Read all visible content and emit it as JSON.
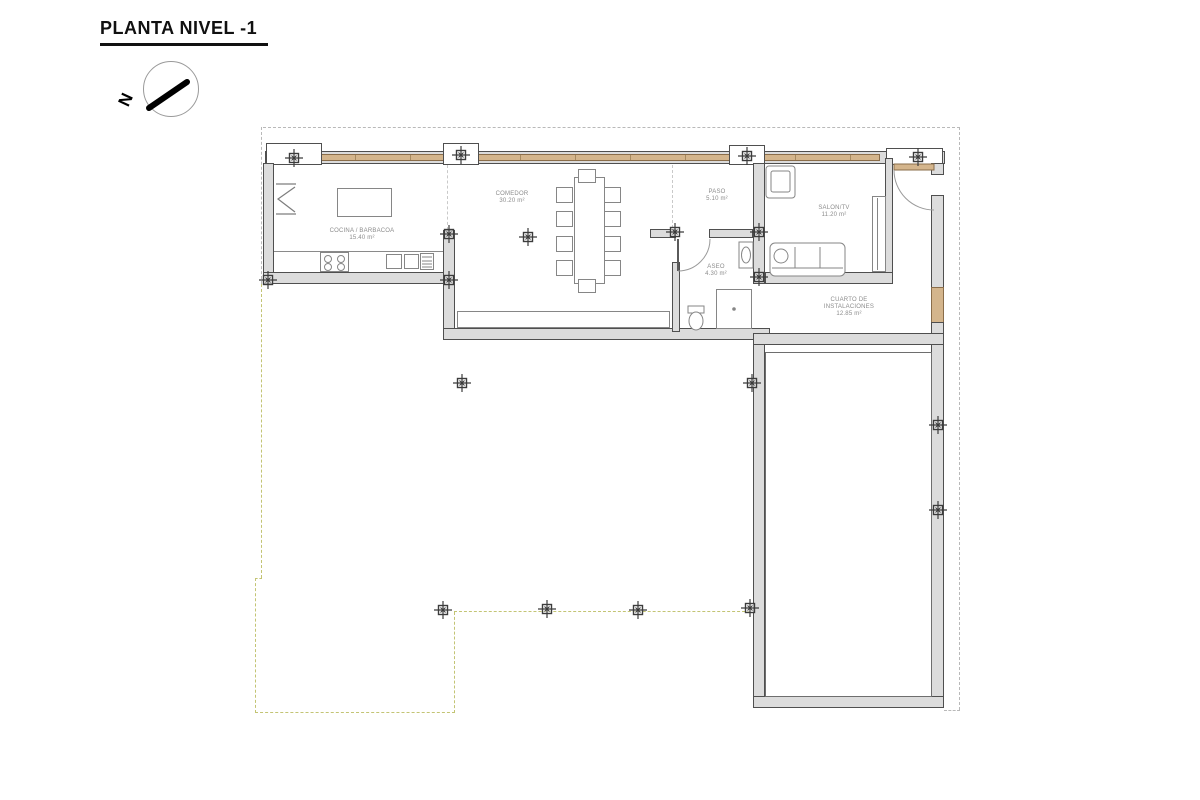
{
  "drawing": {
    "title": "PLANTA NIVEL -1",
    "north_letter": "N"
  },
  "rooms": {
    "cocina": {
      "name": "COCINA / BARBACOA",
      "area": "15.40 m²"
    },
    "comedor": {
      "name": "COMEDOR",
      "area": "30.20 m²"
    },
    "paso": {
      "name": "PASO",
      "area": "5.10 m²"
    },
    "salon": {
      "name": "SALON/TV",
      "area": "11.20 m²"
    },
    "aseo": {
      "name": "ASEO",
      "area": "4.30 m²"
    },
    "cuarto": {
      "name_line1": "CUARTO DE",
      "name_line2": "INSTALACIONES",
      "area": "12.85 m²"
    }
  },
  "colors": {
    "wall_fill": "#dcdcdc",
    "wall_line": "#4f4f4f",
    "wood": "#d4b58c",
    "roof_dash": "#b9b9b9",
    "terrace_dash": "#c3c474",
    "label": "#8c8c8c"
  },
  "columns": [
    [
      294,
      158
    ],
    [
      461,
      155
    ],
    [
      747,
      156
    ],
    [
      918,
      157
    ],
    [
      268,
      280
    ],
    [
      449,
      234
    ],
    [
      449,
      280
    ],
    [
      528,
      237
    ],
    [
      675,
      232
    ],
    [
      759,
      232
    ],
    [
      759,
      277
    ],
    [
      462,
      383
    ],
    [
      752,
      383
    ],
    [
      443,
      610
    ],
    [
      547,
      609
    ],
    [
      638,
      610
    ],
    [
      750,
      608
    ],
    [
      938,
      425
    ],
    [
      938,
      510
    ]
  ]
}
